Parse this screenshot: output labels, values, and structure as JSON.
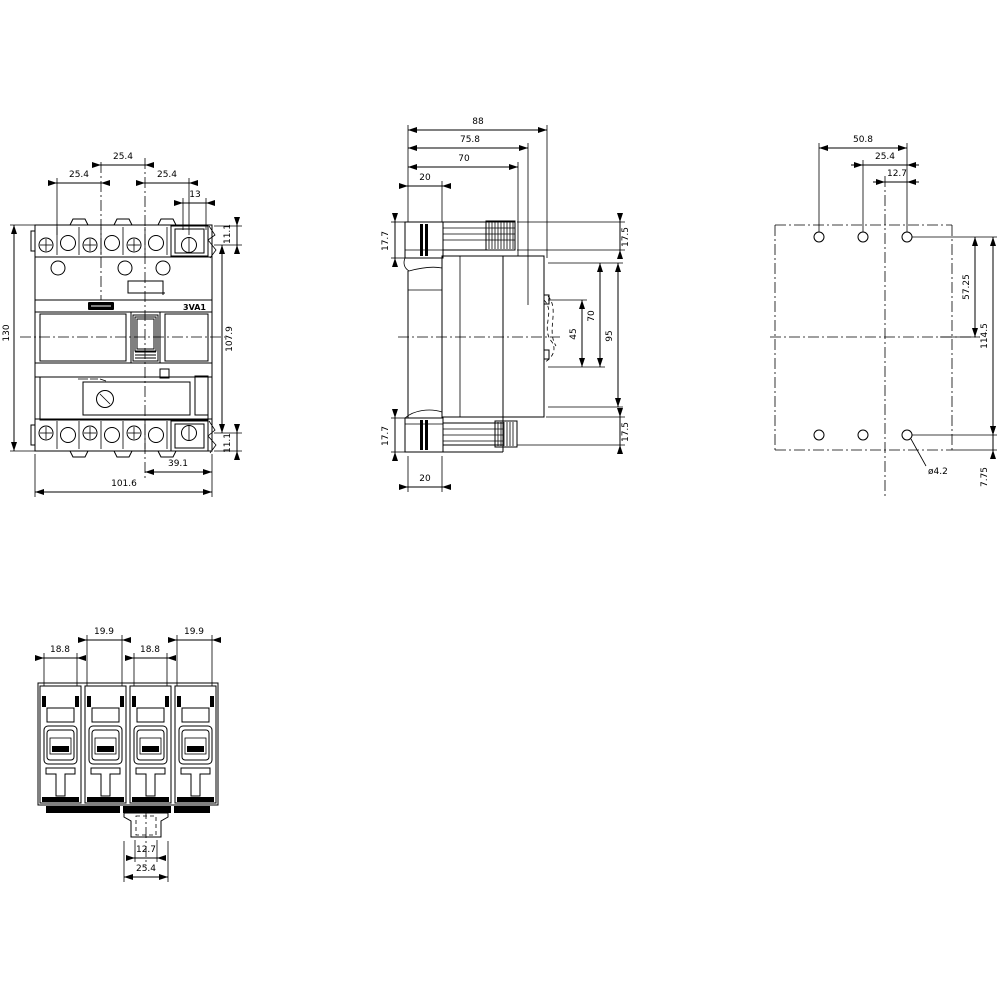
{
  "page": {
    "background": "#ffffff",
    "line_color": "#000000"
  },
  "views": {
    "front": {
      "product_label": "3VA1",
      "dims": {
        "pitch_top": "25.4",
        "pitch_left": "25.4",
        "pitch_right": "25.4",
        "terminal_width": "13",
        "top_offset": "11.1",
        "height": "130",
        "screw_span": "107.9",
        "bottom_offset": "11.1",
        "lower_span": "39.1",
        "width": "101.6"
      }
    },
    "side": {
      "dims": {
        "depth_total": "88",
        "depth_75_8": "75.8",
        "depth_70": "70",
        "front_20_top": "20",
        "top_17_7": "17.7",
        "top_17_5": "17.5",
        "rear_45": "45",
        "rear_70": "70",
        "rear_95": "95",
        "bottom_17_7": "17.7",
        "bottom_17_5": "17.5",
        "front_20_bottom": "20"
      }
    },
    "rear": {
      "dims": {
        "hole_span_50_8": "50.8",
        "hole_span_25_4": "25.4",
        "hole_span_12_7": "12.7",
        "v_57_25": "57.25",
        "v_114_5": "114.5",
        "v_7_75": "7.75",
        "hole_diameter": "ø4.2"
      }
    },
    "bottom": {
      "dims": {
        "pole2_width": "19.9",
        "pole4_width": "19.9",
        "pole1_width": "18.8",
        "pole3_width": "18.8",
        "tab_12_7": "12.7",
        "tab_25_4": "25.4"
      }
    }
  }
}
